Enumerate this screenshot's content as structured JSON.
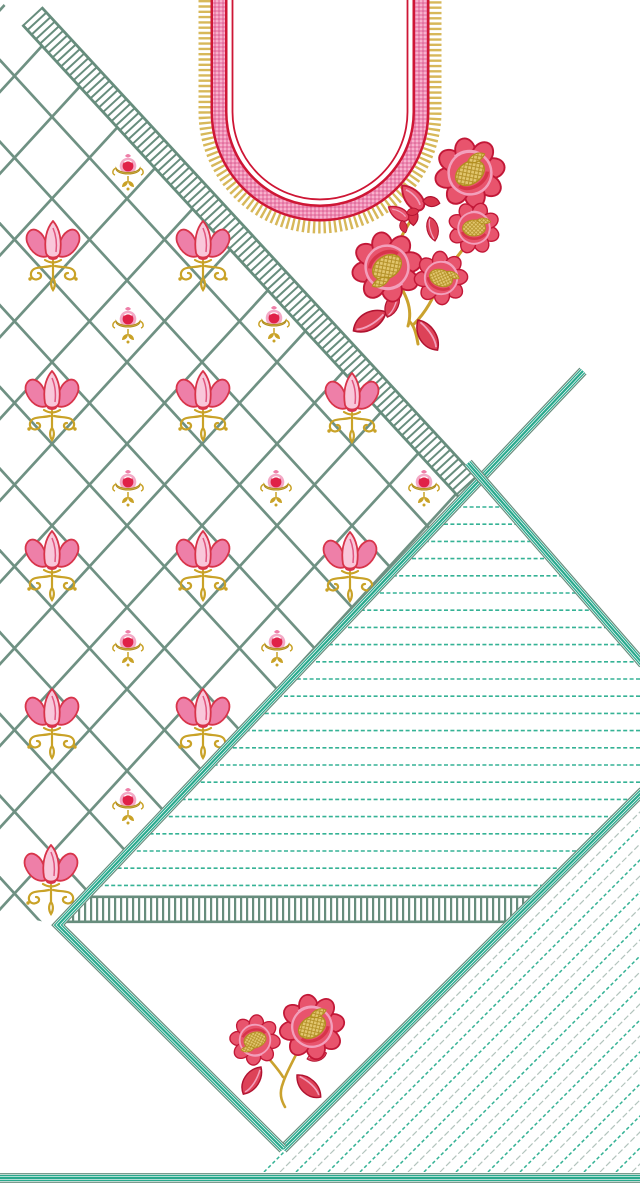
{
  "canvas": {
    "width": 640,
    "height": 1188,
    "background": "#ffffff"
  },
  "palette": {
    "sage": "#678d7d",
    "lattice_green": "#6f9183",
    "teal": "#2aa98d",
    "teal_bright": "#35b295",
    "hatch_gray": "#b3c4bd",
    "red": "#ce1635",
    "crimson": "#d8344a",
    "rose": "#e8546d",
    "pink": "#f2a0bc",
    "pink_pale": "#f9c7da",
    "gold": "#c9a227",
    "gold_light": "#d7b85a",
    "white": "#ffffff"
  },
  "lattice": {
    "clip": [
      [
        0,
        0
      ],
      [
        461,
        499
      ],
      [
        58,
        925
      ],
      [
        0,
        912
      ]
    ],
    "slope": 1.09,
    "step": 75,
    "a0": 19.8,
    "a_kmin": -12,
    "a_kmax": 6,
    "b0": 9.2,
    "b_kmin": 0,
    "b_kmax": 18,
    "span_y": 940,
    "line_width": 2.7,
    "color": "#6f9183"
  },
  "ladder": {
    "center": [
      32,
      16,
      470,
      490
    ],
    "edges": [
      [
        41.5,
        7.2,
        479.5,
        481.2
      ],
      [
        22.5,
        24.8,
        460.5,
        498.8
      ]
    ],
    "width": 26,
    "rung_dash": "2 4.2",
    "edge_width": 2.8,
    "color": "#678d7d"
  },
  "motifs": {
    "tulips": [
      [
        53,
        247
      ],
      [
        203,
        247
      ],
      [
        52,
        397
      ],
      [
        203,
        397
      ],
      [
        352,
        399
      ],
      [
        52,
        557
      ],
      [
        203,
        557
      ],
      [
        350,
        558
      ],
      [
        52,
        715
      ],
      [
        203,
        715
      ],
      [
        51,
        871
      ]
    ],
    "buds": [
      [
        128,
        169
      ],
      [
        128,
        322
      ],
      [
        274,
        321
      ],
      [
        128,
        485
      ],
      [
        276,
        485
      ],
      [
        424,
        485
      ],
      [
        128,
        645
      ],
      [
        277,
        645
      ],
      [
        128,
        803
      ]
    ]
  },
  "stripes": {
    "clip": [
      [
        481,
        479
      ],
      [
        643,
        664
      ],
      [
        643,
        791
      ],
      [
        538,
        897
      ],
      [
        86,
        897
      ]
    ],
    "x_from": 60,
    "x_to": 648,
    "y0": 507,
    "dy": 17.2,
    "count": 23,
    "color": "#35b295",
    "width": 1.6,
    "dash": "4 2.4"
  },
  "comb": {
    "clip": [
      [
        88,
        894
      ],
      [
        542,
        894
      ],
      [
        509,
        926
      ],
      [
        54,
        926
      ]
    ],
    "center": [
      48,
      909.5,
      547,
      909.5
    ],
    "width": 27,
    "rung_dash": "2.2 3.8",
    "edges": [
      [
        84,
        896.8,
        539,
        896.8
      ],
      [
        59,
        921.8,
        512,
        921.8
      ]
    ],
    "edge_width": 2.6,
    "color": "#678d7d"
  },
  "hatch": {
    "clip": [
      [
        643,
        793
      ],
      [
        643,
        1172
      ],
      [
        258,
        1172
      ]
    ],
    "y_base": 1172,
    "x0": 264,
    "dx": 16,
    "count": 24,
    "len": 398,
    "teal": {
      "color": "#35b295",
      "width": 1.5,
      "dash": "3.5 2.5"
    },
    "gray": {
      "color": "#b3c4bd",
      "width": 1.2,
      "dash": "6 2.6"
    }
  },
  "bands": {
    "recipe": [
      [
        "#678d7d",
        9.8
      ],
      [
        "#ffffff",
        7.4
      ],
      [
        "#2aa98d",
        6.2
      ],
      [
        "#ffffff",
        3.6
      ],
      [
        "#2aa98d",
        2.2
      ]
    ],
    "segments": [
      {
        "name": "diamond-right-edge-band",
        "pts": [
          [
            643,
            791
          ],
          [
            283,
            1149
          ]
        ]
      },
      {
        "name": "upper-left-diagonal-band",
        "pts": [
          [
            583,
            371
          ],
          [
            58,
            925
          ],
          [
            283,
            1149
          ]
        ]
      },
      {
        "name": "upper-right-diagonal-band",
        "pts": [
          [
            468,
            463
          ],
          [
            643,
            664
          ]
        ]
      },
      {
        "name": "bottom-border-band",
        "pts": [
          [
            -2,
            1178
          ],
          [
            642,
            1178
          ]
        ]
      }
    ]
  },
  "neckline": {
    "cx": 320,
    "bar_bottom_y": 112,
    "fringe": {
      "r": 115.5,
      "width": 12,
      "dash": "2.4 2.9",
      "color": "#d7b85a"
    },
    "band": {
      "r": 101,
      "width": 17,
      "color": "#ce1635"
    },
    "mesh": {
      "r": 101,
      "width": 12
    },
    "inner_line": {
      "r": 87.5,
      "width": 1.8,
      "color": "#ce1635"
    }
  },
  "sprays": [
    {
      "ref": "spray",
      "name": "rose-spray-large",
      "x": 430,
      "y": 240
    },
    {
      "ref": "sprig",
      "name": "rose-sprig-small",
      "x": 285,
      "y": 1045
    }
  ]
}
